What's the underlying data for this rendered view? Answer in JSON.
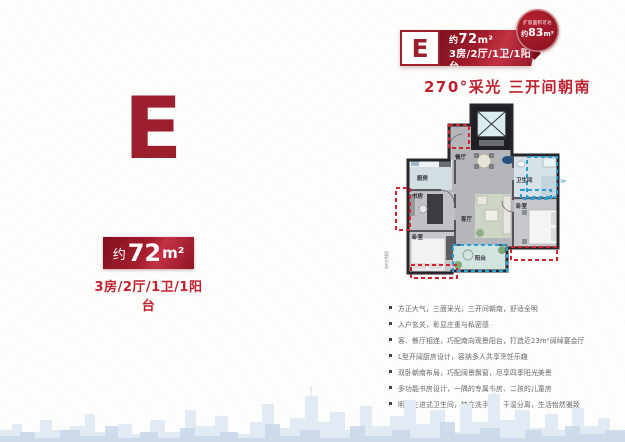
{
  "page": {
    "tagline": "270°采光 三开间朝南"
  },
  "colors": {
    "accent": "#c0212e",
    "dark_red": "#83101f",
    "highlight_red": "#d6212f",
    "highlight_blue": "#2a9fd4"
  },
  "header_badge": {
    "letter": "E",
    "approx": "约",
    "area_num": "72",
    "area_unit": "m²",
    "rooms": "3房/2厅/1卫/1阳台",
    "bubble_line1": "扩容面积可达",
    "bubble_approx": "约",
    "bubble_num": "83",
    "bubble_unit": "m²"
  },
  "left_panel": {
    "letter": "E",
    "approx": "约",
    "area_num": "72",
    "area_unit": "m²",
    "rooms": "3房/2厅/1卫/1阳台"
  },
  "floorplan": {
    "caption": "面积示意",
    "arrow_icon": "≫",
    "rooms": {
      "kitchen": "厨房",
      "dining": "餐厅",
      "bathroom": "卫生间",
      "study": "书房",
      "living": "客厅",
      "bedroom_right": "卧室",
      "bedroom_left": "卧室",
      "balcony": "阳台"
    }
  },
  "features": [
    "方正大气，三面采光，三开间朝南，舒适全明",
    "入户玄关，彰显庄重与私密感",
    "客、餐厅相连，巧配南向观景阳台，打造近23m²阔绰宴会厅",
    "L型开阔厨房设计，容纳多人共享烹饪乐趣",
    "双卧朝南布局，巧配阔景飘窗，尽享四季阳光美景",
    "多功能书房设计，一隅的专属书房、二孩的儿童房",
    "明亮三进式卫生间，独立洗手区，干湿分离，生活怡然雅致"
  ]
}
